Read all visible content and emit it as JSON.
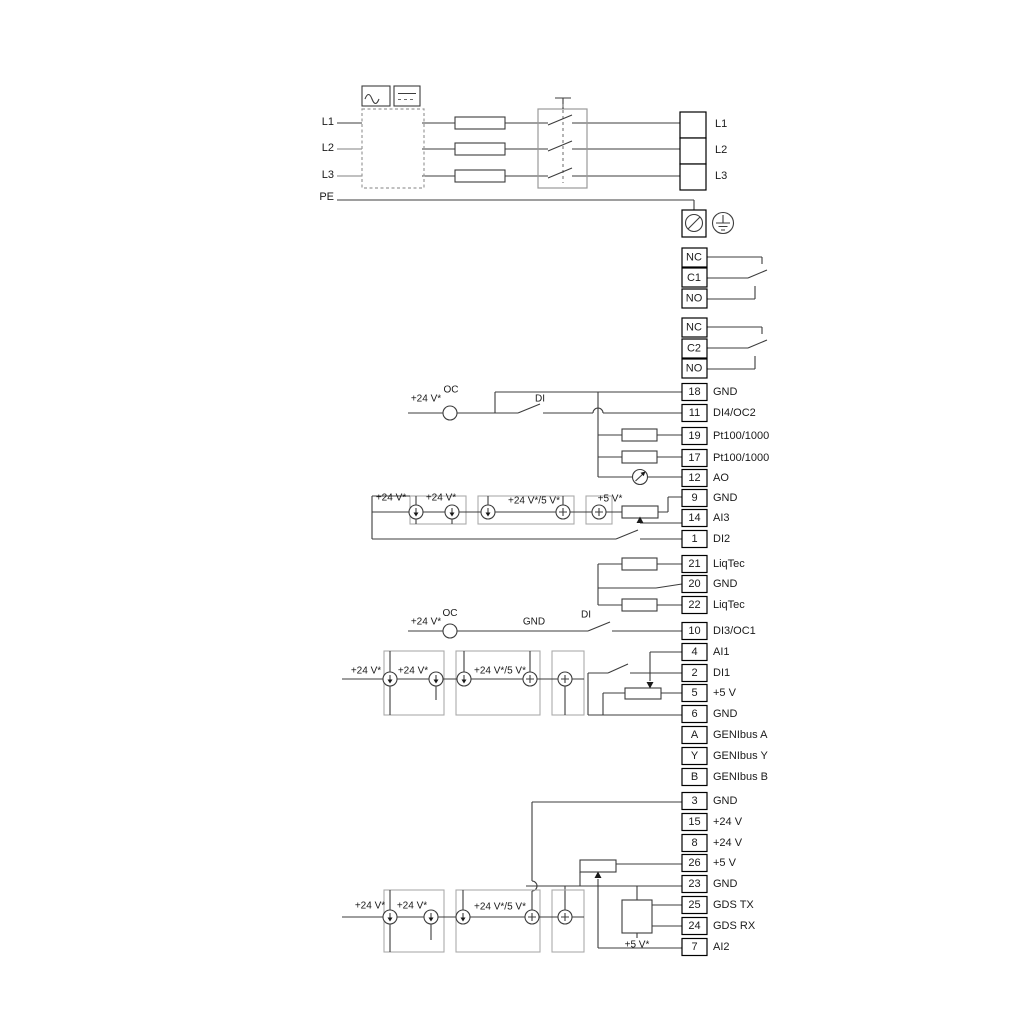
{
  "power": {
    "left": [
      "L1",
      "L2",
      "L3",
      "PE"
    ],
    "right": [
      "L1",
      "L2",
      "L3"
    ]
  },
  "relay1": [
    "NC",
    "C1",
    "NO"
  ],
  "relay2": [
    "NC",
    "C2",
    "NO"
  ],
  "strip_a": [
    {
      "num": "18",
      "label": "GND"
    },
    {
      "num": "11",
      "label": "DI4/OC2"
    },
    {
      "num": "19",
      "label": "Pt100/1000"
    },
    {
      "num": "17",
      "label": "Pt100/1000"
    },
    {
      "num": "12",
      "label": "AO"
    },
    {
      "num": "9",
      "label": "GND"
    },
    {
      "num": "14",
      "label": "AI3"
    },
    {
      "num": "1",
      "label": "DI2"
    }
  ],
  "liqtec": [
    {
      "num": "21",
      "label": "LiqTec"
    },
    {
      "num": "20",
      "label": "GND"
    },
    {
      "num": "22",
      "label": "LiqTec"
    }
  ],
  "strip_b": [
    {
      "num": "10",
      "label": "DI3/OC1"
    },
    {
      "num": "4",
      "label": "AI1"
    },
    {
      "num": "2",
      "label": "DI1"
    },
    {
      "num": "5",
      "label": "+5 V"
    },
    {
      "num": "6",
      "label": "GND"
    },
    {
      "num": "A",
      "label": "GENIbus A"
    },
    {
      "num": "Y",
      "label": "GENIbus Y"
    },
    {
      "num": "B",
      "label": "GENIbus B"
    }
  ],
  "strip_c": [
    {
      "num": "3",
      "label": "GND"
    },
    {
      "num": "15",
      "label": "+24 V"
    },
    {
      "num": "8",
      "label": "+24 V"
    },
    {
      "num": "26",
      "label": "+5 V"
    },
    {
      "num": "23",
      "label": "GND"
    },
    {
      "num": "25",
      "label": "GDS TX"
    },
    {
      "num": "24",
      "label": "GDS RX"
    },
    {
      "num": "7",
      "label": "AI2"
    }
  ],
  "ann": {
    "oc2": {
      "v24": "+24 V*",
      "oc": "OC",
      "di": "DI"
    },
    "oc1": {
      "v24": "+24 V*",
      "oc": "OC",
      "gnd": "GND",
      "di": "DI"
    },
    "ai3": {
      "a": "+24 V*",
      "b": "+24 V*",
      "c": "+24 V*/5 V*",
      "d": "+5 V*"
    },
    "ai1": {
      "a": "+24 V*",
      "b": "+24 V*",
      "c": "+24 V*/5 V*"
    },
    "ai2": {
      "a": "+24 V*",
      "b": "+24 V*",
      "c": "+24 V*/5 V*",
      "d": "+5 V*"
    }
  },
  "colors": {
    "wire": "#3c3c3c",
    "gray_wire": "#9a9a9a",
    "group_box": "#ababab",
    "terminal_border": "#000000",
    "background": "#ffffff"
  }
}
